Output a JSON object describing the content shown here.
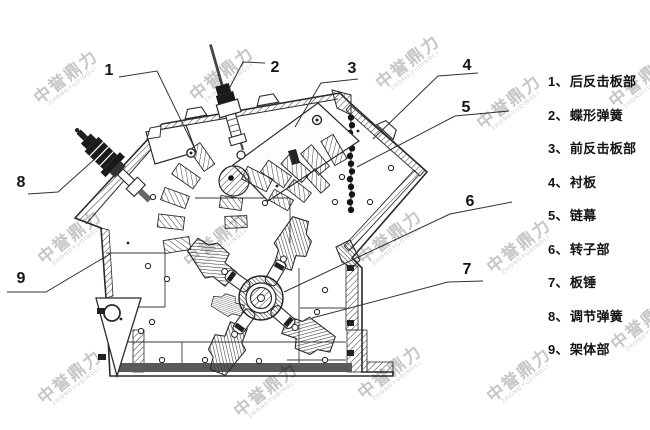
{
  "page": {
    "background": "#ffffff"
  },
  "watermark": {
    "text_cn": "中誉鼎力",
    "text_en": "ZHONGYUDINGLI",
    "color": "#bcbcbc",
    "positions": [
      [
        66,
        77
      ],
      [
        222,
        74
      ],
      [
        408,
        62
      ],
      [
        509,
        102
      ],
      [
        70,
        237
      ],
      [
        216,
        240
      ],
      [
        390,
        237
      ],
      [
        519,
        246
      ],
      [
        70,
        377
      ],
      [
        266,
        390
      ],
      [
        390,
        372
      ],
      [
        519,
        375
      ],
      [
        641,
        80
      ],
      [
        643,
        323
      ]
    ]
  },
  "diagram": {
    "line_color": "#2b2b2b",
    "leader_color": "#333333",
    "callouts": [
      {
        "num": "1",
        "x": 109,
        "y": 75,
        "leader": [
          [
            119,
            77
          ],
          [
            157,
            71
          ],
          [
            194,
            147
          ]
        ]
      },
      {
        "num": "2",
        "x": 275,
        "y": 72,
        "leader": [
          [
            265,
            63
          ],
          [
            243,
            62
          ],
          [
            229,
            89
          ]
        ]
      },
      {
        "num": "3",
        "x": 352,
        "y": 73,
        "leader": [
          [
            358,
            79
          ],
          [
            321,
            83
          ],
          [
            295,
            127
          ]
        ]
      },
      {
        "num": "4",
        "x": 467,
        "y": 70,
        "leader": [
          [
            478,
            73
          ],
          [
            438,
            76
          ],
          [
            373,
            139
          ]
        ]
      },
      {
        "num": "5",
        "x": 466,
        "y": 112,
        "leader": [
          [
            509,
            111
          ],
          [
            455,
            116
          ],
          [
            357,
            167
          ]
        ]
      },
      {
        "num": "6",
        "x": 470,
        "y": 206,
        "leader": [
          [
            512,
            202
          ],
          [
            450,
            214
          ],
          [
            284,
            292
          ]
        ]
      },
      {
        "num": "7",
        "x": 467,
        "y": 274,
        "leader": [
          [
            483,
            281
          ],
          [
            448,
            282
          ],
          [
            312,
            318
          ]
        ]
      },
      {
        "num": "8",
        "x": 21,
        "y": 187,
        "leader": [
          [
            28,
            194
          ],
          [
            58,
            192
          ],
          [
            97,
            157
          ]
        ]
      },
      {
        "num": "9",
        "x": 21,
        "y": 283,
        "leader": [
          [
            7,
            292
          ],
          [
            46,
            292
          ],
          [
            110,
            254
          ]
        ]
      }
    ]
  },
  "legend": {
    "items": [
      {
        "num": "1、",
        "label": "后反击板部"
      },
      {
        "num": "2、",
        "label": "蝶形弹簧"
      },
      {
        "num": "3、",
        "label": "前反击板部"
      },
      {
        "num": "4、",
        "label": "衬板"
      },
      {
        "num": "5、",
        "label": "链幕"
      },
      {
        "num": "6、",
        "label": "转子部"
      },
      {
        "num": "7、",
        "label": "板锤"
      },
      {
        "num": "8、",
        "label": "调节弹簧"
      },
      {
        "num": "9、",
        "label": "架体部"
      }
    ]
  }
}
